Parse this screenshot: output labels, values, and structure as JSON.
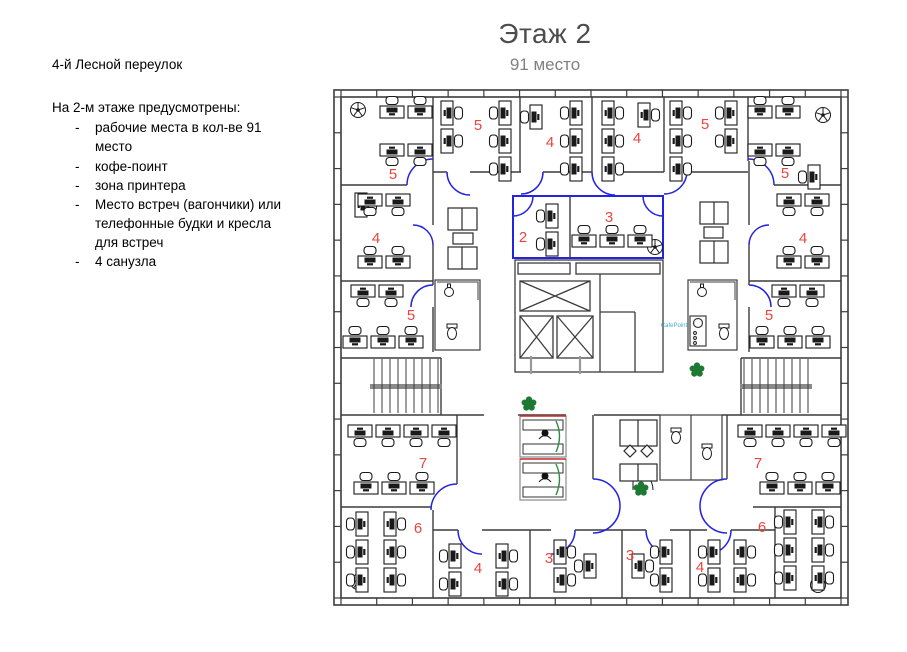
{
  "page": {
    "title": "Этаж 2",
    "subtitle": "91 место"
  },
  "info": {
    "address": "4-й Лесной переулок",
    "list_title": "На 2-м этаже предусмотрены:",
    "marker": "-",
    "items": [
      "рабочие места в кол-ве 91 место",
      "кофе-поинт",
      "зона принтера",
      "Место встреч (вагончики) или телефонные будки и кресла для встреч",
      "4 санузла"
    ]
  },
  "plan": {
    "cafe_point_label": "CafePoint",
    "colors": {
      "wall": "#3c3c3c",
      "door_blue": "#2323e0",
      "room_number_red": "#e8473f",
      "plant_green": "#1e7a33",
      "booth_red": "#cc3333",
      "booth_green": "#2e8b46"
    },
    "rooms": [
      {
        "area": "top-left-corner",
        "seats": "5"
      },
      {
        "area": "left-upper",
        "seats": "4"
      },
      {
        "area": "left-lower",
        "seats": "5"
      },
      {
        "area": "top-1",
        "seats": "5"
      },
      {
        "area": "top-2",
        "seats": "4"
      },
      {
        "area": "top-3",
        "seats": "4"
      },
      {
        "area": "top-4",
        "seats": "5"
      },
      {
        "area": "top-right-corner",
        "seats": "5"
      },
      {
        "area": "right-upper",
        "seats": "4"
      },
      {
        "area": "right-lower",
        "seats": "5"
      },
      {
        "area": "center-meeting-left",
        "seats": "2"
      },
      {
        "area": "center-meeting-right",
        "seats": "3"
      },
      {
        "area": "bottom-left-big",
        "seats": "7"
      },
      {
        "area": "bottom-left-small",
        "seats": "6"
      },
      {
        "area": "bottom-mid-1",
        "seats": "4"
      },
      {
        "area": "bottom-mid-2",
        "seats": "3"
      },
      {
        "area": "bottom-mid-3",
        "seats": "3"
      },
      {
        "area": "bottom-mid-4",
        "seats": "4"
      },
      {
        "area": "bottom-right-big",
        "seats": "7"
      },
      {
        "area": "bottom-right-small",
        "seats": "6"
      }
    ]
  }
}
